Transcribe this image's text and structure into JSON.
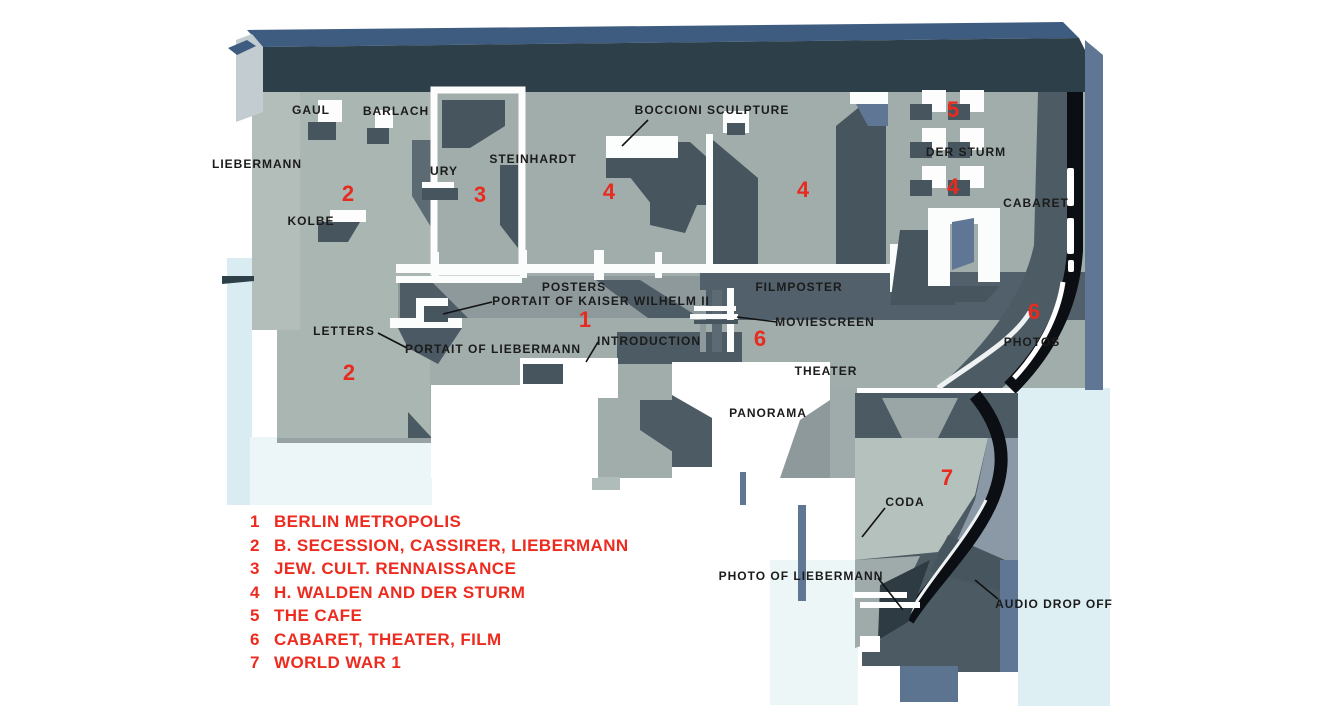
{
  "plan": {
    "room_labels": [
      {
        "text": "GAUL"
      },
      {
        "text": "BARLACH"
      },
      {
        "text": "LIEBERMANN"
      },
      {
        "text": "URY"
      },
      {
        "text": "STEINHARDT"
      },
      {
        "text": "KOLBE"
      },
      {
        "text": "BOCCIONI SCULPTURE"
      },
      {
        "text": "DER STURM"
      },
      {
        "text": "CABARET"
      },
      {
        "text": "POSTERS"
      },
      {
        "text": "PORTAIT OF KAISER WILHELM II"
      },
      {
        "text": "FILMPOSTER"
      },
      {
        "text": "MOVIESCREEN"
      },
      {
        "text": "LETTERS"
      },
      {
        "text": "PORTAIT OF LIEBERMANN"
      },
      {
        "text": "INTRODUCTION"
      },
      {
        "text": "THEATER"
      },
      {
        "text": "PANORAMA"
      },
      {
        "text": "PHOTOS"
      },
      {
        "text": "CODA"
      },
      {
        "text": "PHOTO OF LIEBERMANN"
      },
      {
        "text": "AUDIO DROP OFF"
      }
    ],
    "zone_markers": [
      {
        "num": "2"
      },
      {
        "num": "3"
      },
      {
        "num": "4"
      },
      {
        "num": "4"
      },
      {
        "num": "5"
      },
      {
        "num": "4"
      },
      {
        "num": "1"
      },
      {
        "num": "6"
      },
      {
        "num": "6"
      },
      {
        "num": "2"
      },
      {
        "num": "7"
      }
    ]
  },
  "legend": {
    "items": [
      {
        "num": "1",
        "text": "BERLIN METROPOLIS"
      },
      {
        "num": "2",
        "text": "B. SECESSION, CASSIRER, LIEBERMANN"
      },
      {
        "num": "3",
        "text": "JEW. CULT. RENNAISSANCE"
      },
      {
        "num": "4",
        "text": "H. WALDEN AND DER STURM"
      },
      {
        "num": "5",
        "text": "THE CAFE"
      },
      {
        "num": "6",
        "text": "CABARET, THEATER, FILM"
      },
      {
        "num": "7",
        "text": "WORLD WAR 1"
      }
    ]
  },
  "colors": {
    "background": "#ffffff",
    "floor": "#a1adab",
    "floor_light": "#b3beba",
    "wall_dark": "#2d3f49",
    "wall_navy": "#3e5c80",
    "wall_blue": "#5f7795",
    "shadow": "#46555e",
    "dark_zone": "#4d5c64",
    "ribbon_black": "#0b0e12",
    "tint_blue": "#ddeff3",
    "accent_red": "#e82b1f",
    "label_black": "#1b1b1b"
  }
}
